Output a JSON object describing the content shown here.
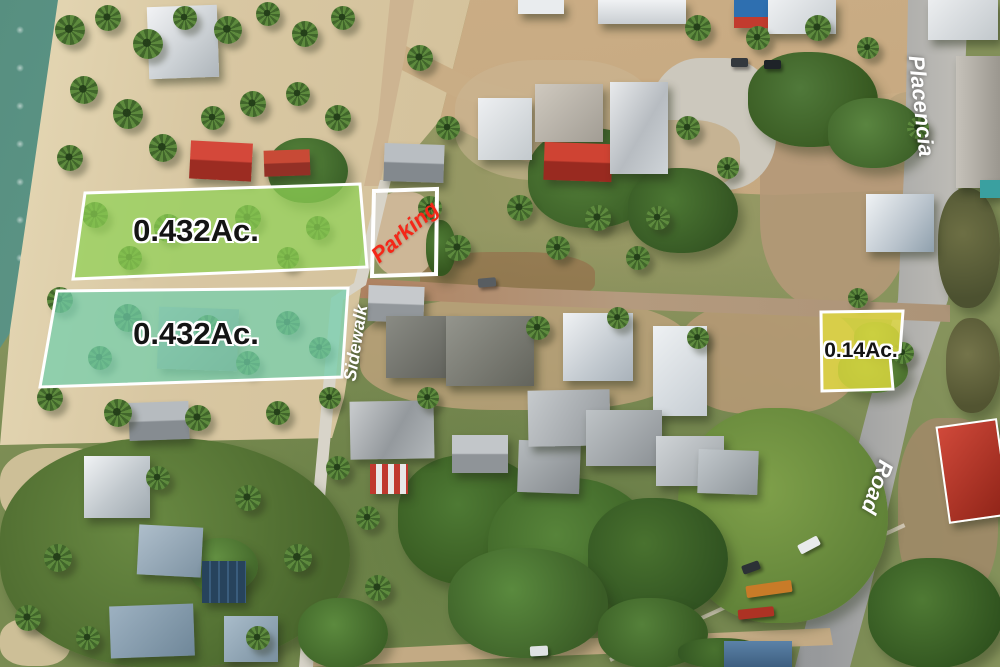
{
  "lots": [
    {
      "area_label": "0.432Ac.",
      "fill_color": "#8FD155",
      "border_color": "#FFFFFF",
      "label_color": "#141414"
    },
    {
      "area_label": "0.432Ac.",
      "fill_color": "#72CEAC",
      "border_color": "#FFFFFF",
      "label_color": "#141414"
    },
    {
      "area_label": "0.14Ac.",
      "fill_color": "#E3DC3E",
      "border_color": "#FFFFFF",
      "label_color": "#141414"
    }
  ],
  "annotations": {
    "parking": {
      "label": "Parking",
      "color": "#F42718",
      "border_color": "#FFFFFF"
    },
    "sidewalk": {
      "label": "Sidewalk",
      "color": "#FFFFFF"
    },
    "street_placencia": {
      "label": "Placencia",
      "color": "#FFFFFF"
    },
    "street_road": {
      "label": "Road",
      "color": "#FFFFFF"
    }
  }
}
